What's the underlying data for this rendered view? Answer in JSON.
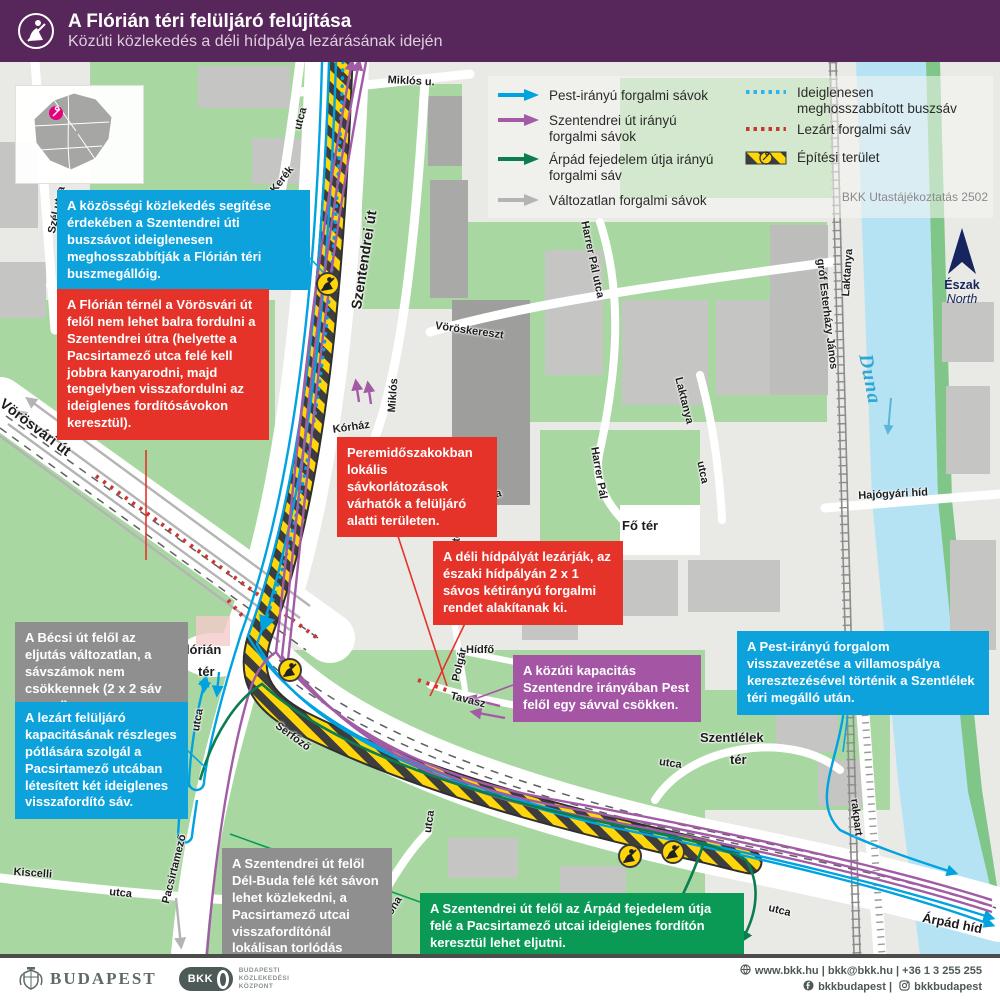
{
  "header": {
    "title": "A Flórián téri felüljáró felújítása",
    "subtitle": "Közúti közlekedés a déli hídpálya lezárásának idején"
  },
  "inset": {
    "city": "Budapest"
  },
  "legend": {
    "items": [
      {
        "symbol": "arrow",
        "color": "#00a3e0",
        "label": "Pest-irányú forgalmi sávok"
      },
      {
        "symbol": "arrow",
        "color": "#a25ca6",
        "label": "Szentendrei út irányú\nforgalmi sávok"
      },
      {
        "symbol": "arrow",
        "color": "#0b7d4f",
        "label": "Árpád fejedelem útja irányú\nforgalmi sáv"
      },
      {
        "symbol": "arrow",
        "color": "#b4b4b4",
        "label": "Változatlan forgalmi sávok"
      },
      {
        "symbol": "dotted",
        "color": "#2fb4e9",
        "label": "Ideiglenesen\nmeghosszabbított buszsáv"
      },
      {
        "symbol": "dotted",
        "color": "#c9382e",
        "label": "Lezárt forgalmi sáv"
      },
      {
        "symbol": "hatch",
        "color": "#ffd60a",
        "label": "Építési terület"
      }
    ],
    "credit": "BKK Utastájékoztatás 2502"
  },
  "compass": {
    "hu": "Észak",
    "en": "North"
  },
  "callouts": [
    "A közösségi közlekedés segítése érdekében a Szentendrei úti buszsávot ideiglenesen meghosszabbítják a Flórián téri buszmegállóig.",
    "A Flórián térnél a Vörösvári út felől nem lehet balra fordulni a Szentendrei útra (helyette a Pacsirtamező utca felé kell jobbra kanyarodni, majd tengelyben visszafordulni az ideiglenes fordítósávokon keresztül).",
    "Peremidőszakokban lokális sávkorlátozások várhatók a felüljáró alatti területen.",
    "A déli hídpályát lezárják, az északi hídpályán 2 x 1 sávos kétirányú forgalmi rendet alakítanak ki.",
    "A Bécsi út felől az eljutás változatlan, a sávszámok nem csökkennek (2 x 2 sáv marad).",
    "A lezárt felüljáró kapacitásának részleges pótlására szolgál a Pacsirtamező utcában létesített két ideiglenes visszafordító sáv.",
    "A közúti kapacitás Szentendre irányában Pest felől egy sávval csökken.",
    "A Pest-irányú forgalom visszavezetése a villamospálya keresztezésével történik a Szentlélek téri megálló után.",
    "A Szentendrei út felől Dél-Buda felé két sávon lehet közlekedni, a Pacsirtamező utcai visszafordítónál lokálisan torlódás alakulhat ki.",
    "A Szentendrei út felől az Árpád fejedelem útja felé a Pacsirtamező utcai ideiglenes fordítón keresztül lehet eljutni."
  ],
  "map": {
    "labels": [
      "Szél utca",
      "utca",
      "Kerék",
      "Kórház u.",
      "Miklós u.",
      "Szentendrei út",
      "Miklós",
      "Kórház",
      "utca",
      "utca",
      "Vöröskereszt",
      "Harrer Pál utca",
      "Harrer Pál",
      "Laktanya",
      "Laktanya",
      "utca",
      "Fő tér",
      "Hídfő",
      "Polgár",
      "Tavasz",
      "Flórián",
      "tér",
      "utca",
      "Serfőző",
      "utca",
      "Kiskorona",
      "utca",
      "Szentlélek",
      "tér",
      "utca",
      "rakpart",
      "Árpád híd",
      "Kiscelli",
      "utca",
      "Pacsirtamező",
      "Vörösvári út",
      "gróf Esterházy János",
      "Hajógyári híd",
      "Duna"
    ]
  },
  "colors": {
    "header_purple": "#57265a",
    "pest_blue": "#00a3e0",
    "szentendrei_purple": "#a25ca6",
    "arpad_green": "#0b7d4f",
    "unchanged_gray": "#b4b4b4",
    "closed_red": "#c9382e",
    "construction_yellow": "#ffd60a",
    "callout_red": "#e5332a",
    "callout_blue": "#0ea2dc",
    "callout_gray": "#8f8f8f",
    "callout_purple": "#a455a4",
    "callout_green": "#0a9a55"
  },
  "footer": {
    "budapest": "BUDAPEST",
    "bkk": "BKK",
    "bkk_org": "BUDAPESTI\nKÖZLEKEDÉSI\nKÖZPONT",
    "contact": "www.bkk.hu | bkk@bkk.hu | +36 1 3 255 255",
    "social_fb": "bkkbudapest",
    "social_sep": "|",
    "social_ig": "bkkbudapest"
  }
}
